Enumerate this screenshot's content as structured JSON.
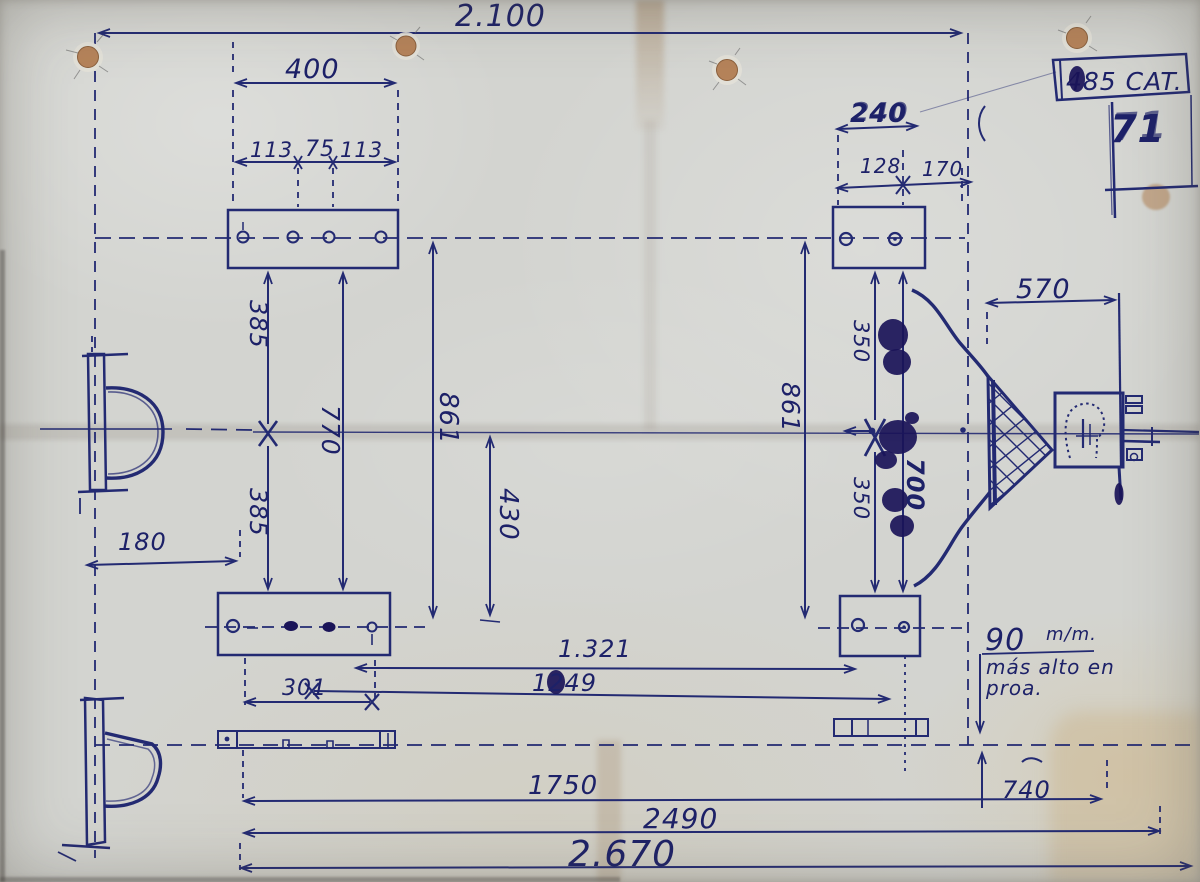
{
  "document": {
    "type": "hand-drawn chassis blueprint photo",
    "ink_color": "#232a72",
    "paper_color": "#d3d4d0"
  },
  "title_block": {
    "category": "485 CAT.",
    "sheet_number": "71"
  },
  "note": {
    "value": "90",
    "unit": "m/m.",
    "line2": "más alto en",
    "line3": "proa."
  },
  "dimensions": {
    "overall_top": "2.100",
    "plate_width": "400",
    "hole_left": "113",
    "hole_center": "75",
    "hole_right": "113",
    "front_plate": "240",
    "front_left": "128",
    "front_right": "170",
    "drawbar": "570",
    "left_upper_half": "385",
    "left_lower_half": "385",
    "left_span": "770",
    "left_overall": "861",
    "half_track": "430",
    "right_overall": "861",
    "right_upper_half": "350",
    "right_lower_half": "350",
    "right_span": "700",
    "mid_span": "1.321",
    "mid_span2": "1249",
    "rear_offset": "301",
    "bracket_offset": "180",
    "height_offset": "740",
    "length_rear": "1750",
    "length_mid": "2490",
    "overall_length": "2.670"
  }
}
